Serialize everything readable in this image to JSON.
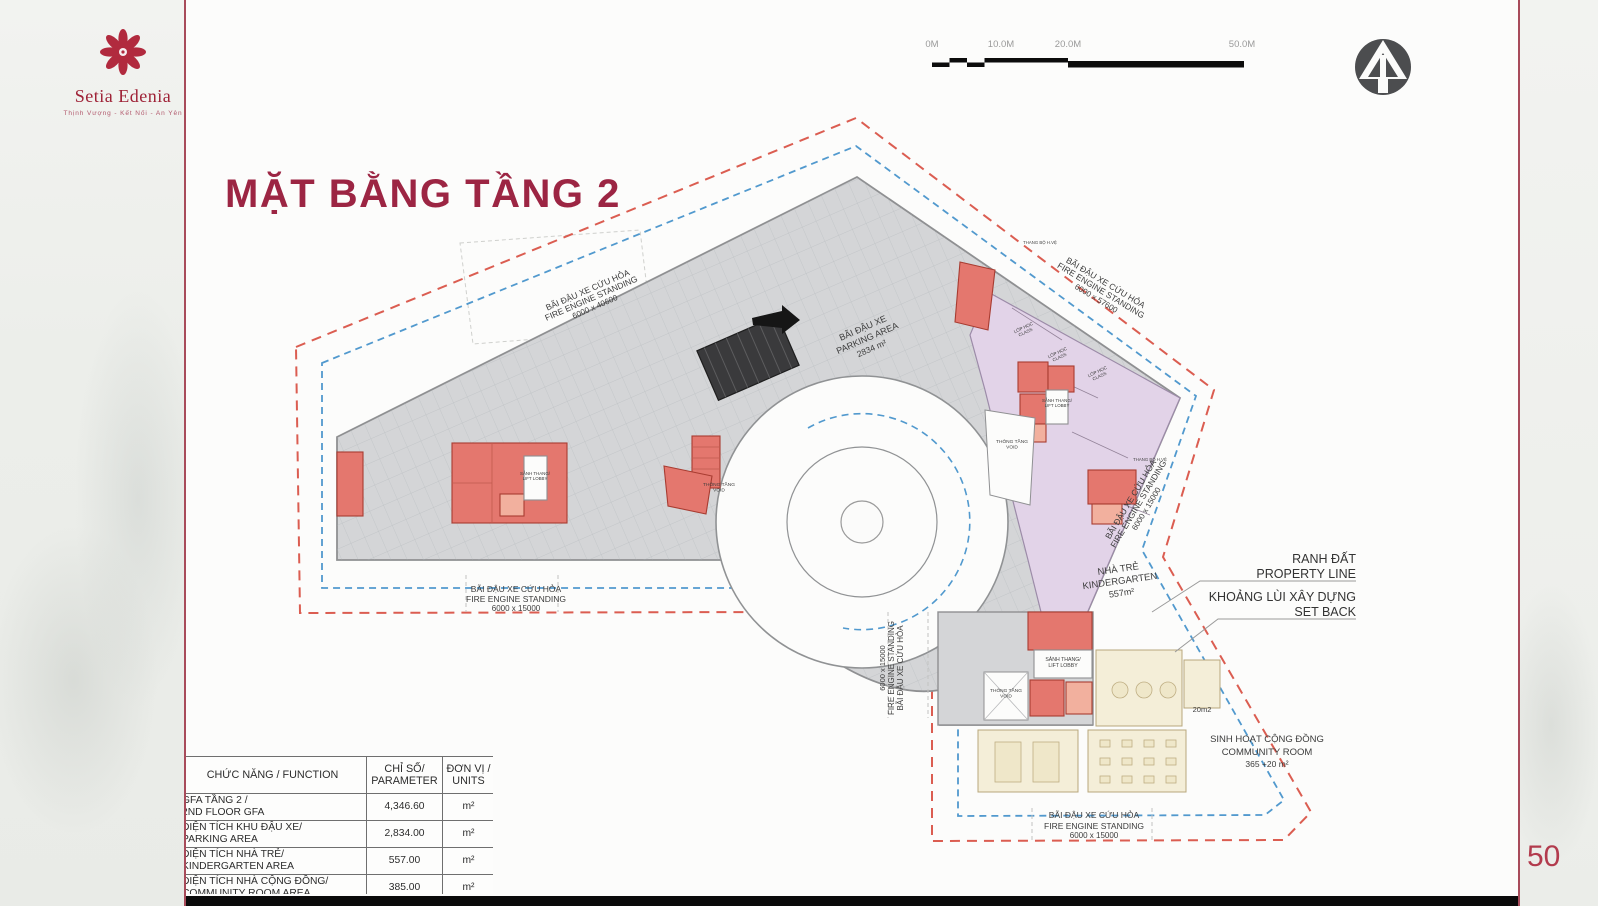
{
  "page": {
    "number": "50"
  },
  "brand": {
    "name": "Setia Edenia",
    "tagline": "Thịnh Vượng - Kết Nối - An Yên"
  },
  "title": "MẶT BẰNG TẦNG 2",
  "icons": {
    "logo": "flower-logo-icon",
    "north": "north-arrow-icon"
  },
  "scalebar": {
    "t0": "0M",
    "t10": "10.0M",
    "t20": "20.0M",
    "t50": "50.0M"
  },
  "table": {
    "headers": {
      "h1": "CHỨC NĂNG / FUNCTION",
      "h2a": "CHỈ SỐ/",
      "h2b": "PARAMETER",
      "h3a": "ĐƠN VỊ /",
      "h3b": "UNITS"
    },
    "rows": [
      {
        "vi": "GFA TẦNG 2 /",
        "en": "2ND FLOOR GFA",
        "value": "4,346.60",
        "unit": "m²"
      },
      {
        "vi": "DIỆN TÍCH KHU ĐẬU XE/",
        "en": "PARKING AREA",
        "value": "2,834.00",
        "unit": "m²"
      },
      {
        "vi": "DIỆN TÍCH NHÀ TRẺ/",
        "en": "KINDERGARTEN AREA",
        "value": "557.00",
        "unit": "m²"
      },
      {
        "vi": "DIỆN TÍCH NHÀ CỘNG ĐỒNG/",
        "en": "COMMUNITY ROOM AREA",
        "value": "385.00",
        "unit": "m²"
      }
    ]
  },
  "plan": {
    "fire": {
      "l1": "BÃI ĐẬU XE CỨU HỎA",
      "l2": "FIRE ENGINE STANDING"
    },
    "dims": {
      "d40600": "6000 x 40600",
      "d57600": "6000 x 57600",
      "d15000": "6000 x 15000"
    },
    "parking": {
      "l1": "BÃI ĐẬU XE",
      "l2": "PARKING AREA",
      "l3": "2834 m²"
    },
    "kindergarten": {
      "l1": "NHÀ TRẺ",
      "l2": "KINDERGARTEN",
      "l3": "557m²"
    },
    "community": {
      "l1": "SINH HOẠT CỘNG ĐỒNG",
      "l2": "COMMUNITY ROOM",
      "l3": "365 +20 m²"
    },
    "property": {
      "l1": "RANH ĐẤT",
      "l2": "PROPERTY LINE"
    },
    "setback": {
      "l1": "KHOẢNG LÙI XÂY DỰNG",
      "l2": "SET BACK"
    },
    "lift": {
      "l1": "SẢNH THANG/",
      "l2": "LIFT LOBBY"
    },
    "void": {
      "l1": "THÔNG TẦNG",
      "l2": "VOID"
    },
    "classroom": {
      "l1": "LỚP HỌC",
      "l2": "CLASS"
    },
    "room20": "20m2",
    "stair_tag": "THANG BỘ H.VỆ"
  },
  "colors": {
    "accent_red": "#9c2543",
    "border_red": "#a84b5a",
    "property_line": "#d84f42",
    "setback_line": "#3e8ec9",
    "parking_gray": "#d4d5d7",
    "kindergarten_purple": "#e2d3e8",
    "community_cream": "#f4eed8",
    "core_red": "#e4776e"
  }
}
